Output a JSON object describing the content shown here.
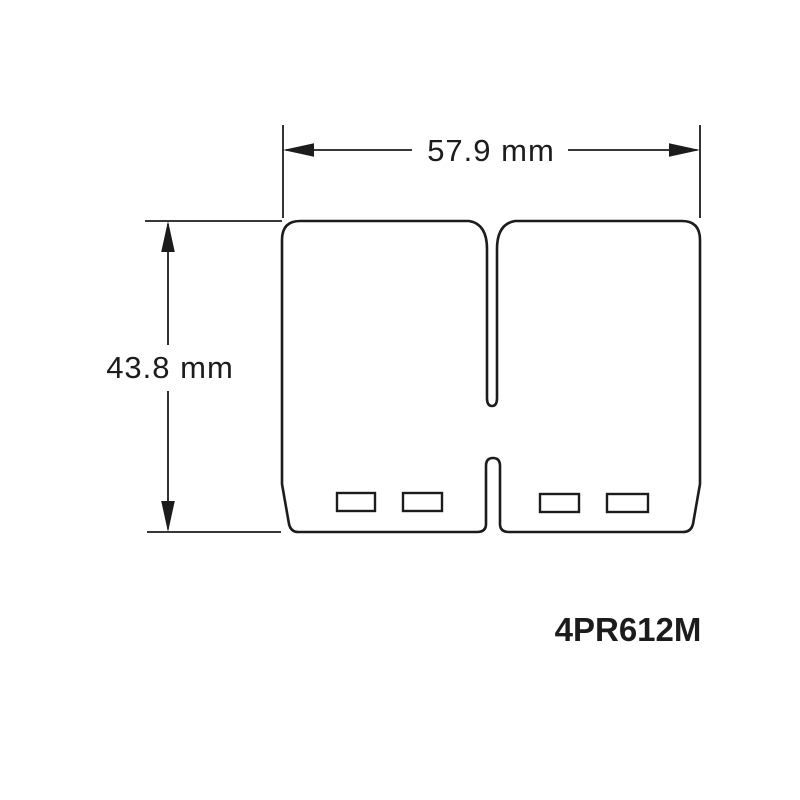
{
  "diagram": {
    "part_number": "4PR612M",
    "dimensions": {
      "width": {
        "label": "57.9 mm",
        "value": 57.9,
        "unit": "mm"
      },
      "height": {
        "label": "43.8 mm",
        "value": 43.8,
        "unit": "mm"
      }
    },
    "features": {
      "petal_lobes": 2,
      "mounting_windows": 4
    }
  },
  "colors": {
    "line": "#1c1c1c",
    "background": "#ffffff"
  }
}
